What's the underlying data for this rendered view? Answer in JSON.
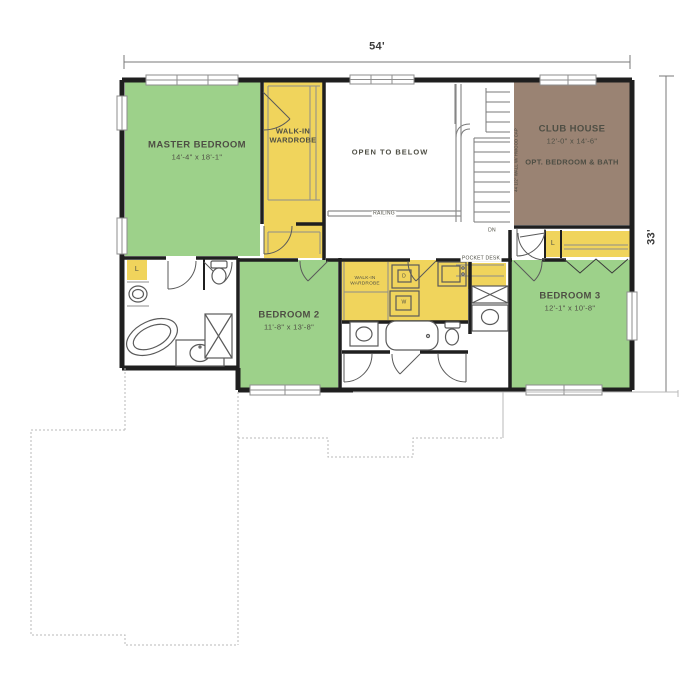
{
  "plan": {
    "overall_width": "54'",
    "overall_depth": "33'"
  },
  "rooms": {
    "master_bedroom": {
      "name": "MASTER BEDROOM",
      "size": "14'-4\" x 18'-1\""
    },
    "master_wardrobe": {
      "name": "WALK-IN WARDROBE"
    },
    "open_to_below": {
      "name": "OPEN TO BELOW"
    },
    "club_house": {
      "name": "CLUB HOUSE",
      "size": "12'-0\" x 14'-6\"",
      "note": "OPT. BEDROOM & BATH"
    },
    "bedroom_2": {
      "name": "BEDROOM 2",
      "size": "11'-8\" x 13'-8\""
    },
    "bedroom_3": {
      "name": "BEDROOM 3",
      "size": "12'-1\" x 10'-8\""
    },
    "hall_wardrobe": {
      "name": "WALK-IN WARDROBE"
    }
  },
  "annotations": {
    "railing": "RAILING",
    "pocket_desk": "POCKET DESK",
    "down": "DN",
    "linen": "L",
    "dryer": "D",
    "washer": "W",
    "half_wall_note": "44 1/2\" WALL W/ HWOOD CAP"
  },
  "colors": {
    "bedroom_green": "#9dd18a",
    "closet_yellow": "#f0d45c",
    "club_house_brown": "#9a8373",
    "wall_black": "#1f1f1f",
    "line_gray": "#8d8d8d",
    "text_gray": "#4e4e44"
  }
}
